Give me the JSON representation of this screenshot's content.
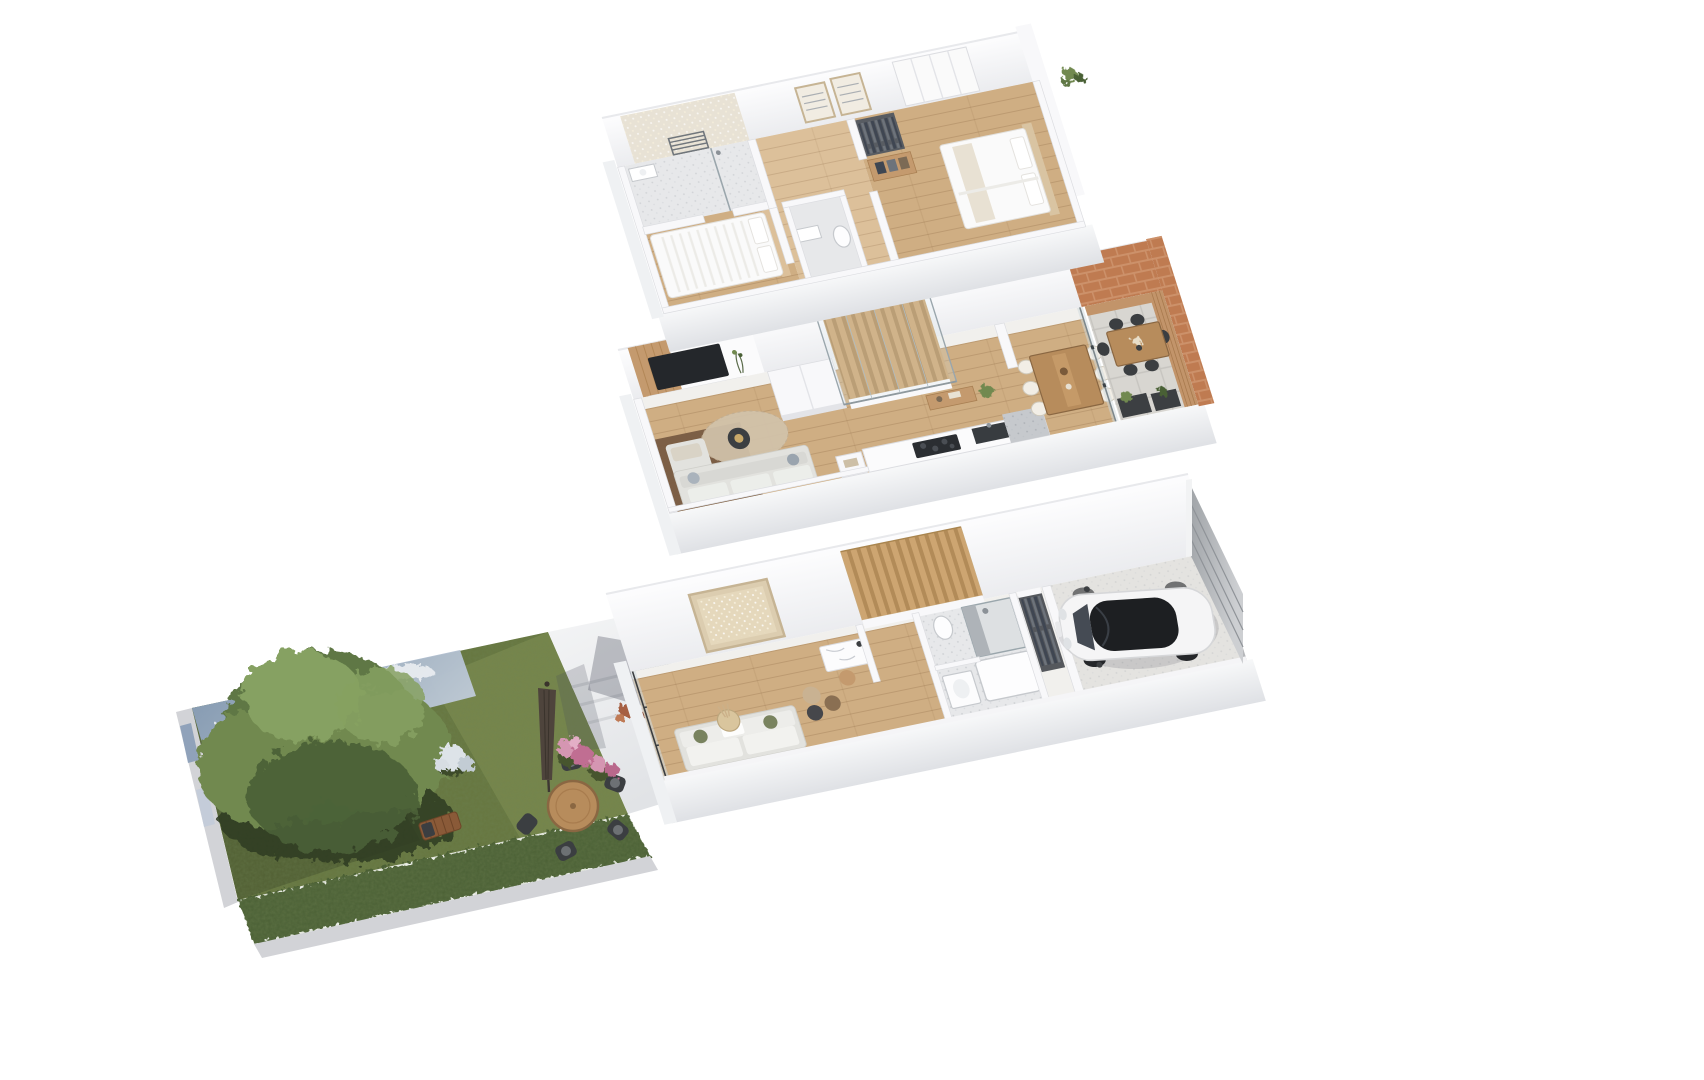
{
  "scene": {
    "title": "Exploded axonometric 3D floor-plan render of a three-storey townhouse with rear garden",
    "floors": [
      {
        "id": "upper-floor",
        "label": "Upper floor - two bedrooms and bathroom",
        "items": [
          "bathroom",
          "towel-radiator",
          "shower",
          "double-bed-left",
          "wall-frames",
          "dresser",
          "open-wardrobe",
          "wc",
          "double-bed-right",
          "fitted-wardrobe",
          "parapet-plant"
        ]
      },
      {
        "id": "main-floor",
        "label": "Main floor - living room, kitchen, dining and terrace",
        "items": [
          "media-wall",
          "tv",
          "wall-shelf",
          "sofa",
          "rug",
          "coffee-table",
          "staircase",
          "glass-balustrade",
          "hall-closet",
          "console-table",
          "kitchen-counter",
          "cooktop",
          "sink",
          "dining-table",
          "dining-chairs",
          "glass-partition",
          "terrace",
          "outdoor-table",
          "outdoor-chairs",
          "planters",
          "brick-wall"
        ]
      },
      {
        "id": "ground-floor",
        "label": "Ground floor - entry lounge, study nook, shower room and garage",
        "items": [
          "wall-art",
          "sofa",
          "poufs",
          "jute-basket",
          "study-desk",
          "staircase",
          "shower-room",
          "shower",
          "bathtub",
          "washbasin",
          "toilet",
          "open-wardrobe",
          "garage",
          "car",
          "garage-door",
          "glazed-front"
        ]
      },
      {
        "id": "garden",
        "label": "Garden - lawn, mature tree, patio and outdoor dining",
        "items": [
          "sky-backdrop",
          "kerb",
          "lawn",
          "hedge",
          "tree",
          "tree-shadow",
          "sun-lounger",
          "outdoor-dining-set",
          "parasol",
          "parasol-shadow",
          "flower-bed",
          "white-bloom-bush",
          "patio",
          "patio-steps",
          "dried-bouquet"
        ]
      }
    ]
  },
  "palette": {
    "wall": "#f8f8fa",
    "wallShade": "#e3e4e8",
    "wallEdge": "#dcdde1",
    "plinthTop": "#f7f8f9",
    "plinthBottom": "#dfe1e5",
    "floorBase": "#f1f0ed",
    "wood": "#cfae83",
    "woodLight": "#dcc09a",
    "woodDark": "#7c5f46",
    "woodPanel": "#c49a6e",
    "tile": "#e7e8ea",
    "tileDark": "#c6c9cd",
    "stepLight": "#cda571",
    "stepDark": "#b28b58",
    "counter": "#2b2e32",
    "dark": "#3c3f42",
    "glass": "#cfdade",
    "glassFrame": "#9aa6ac",
    "brick": "#bf7b51",
    "brickLine": "#d29a74",
    "deck": "#c2946a",
    "paver": "#d8d6d1",
    "paverLine": "#c6c4bf",
    "sofa": "#e2e2de",
    "cushion": "#79835f",
    "rug": "#d2c3ab",
    "bedWhite": "#fafafa",
    "art": "#dccdb0",
    "artFrame": "#c6b494",
    "tv": "#24272b",
    "grass": "#66763f",
    "grassLight": "#8a9a58",
    "grassDark": "#3f4d2a",
    "hedge": "#4c6134",
    "tree1": "#5e7745",
    "tree2": "#71894f",
    "tree3": "#4a6136",
    "treeHi": "#86a162",
    "treeShadow": "#2e3a20",
    "sky": "#7f96b3",
    "skyLight": "#c0cbd9",
    "cloud": "#f3f5f7",
    "curb": "#d2d3d7",
    "patio": "#eef0f1",
    "tableWood": "#b78c5c",
    "tableEdge": "#8a6742",
    "chairDark": "#3b3e41",
    "parasol": "#4e443c",
    "flowerPink": "#d596b2",
    "flowerDeep": "#c06e92",
    "bloomWhite": "#dde3e8",
    "bouquet": "#a65f43",
    "carBody": "#f5f5f6",
    "carRoof": "#1d1f22",
    "carGlass": "#454b54",
    "wheel": "#25272a",
    "garageFloor": "#e4e3e0",
    "garageDoorA": "#9fa3a7",
    "garageDoorB": "#cdcfd2",
    "radiator": "#70767c",
    "clothesA": "#3f4652",
    "clothesB": "#6d737b",
    "shadowSoft": "rgba(70,76,90,0.32)",
    "basket": "#d9c59d",
    "pouf1": "#c9b292",
    "pouf2": "#8a6f52",
    "pouf3": "#46474b"
  }
}
